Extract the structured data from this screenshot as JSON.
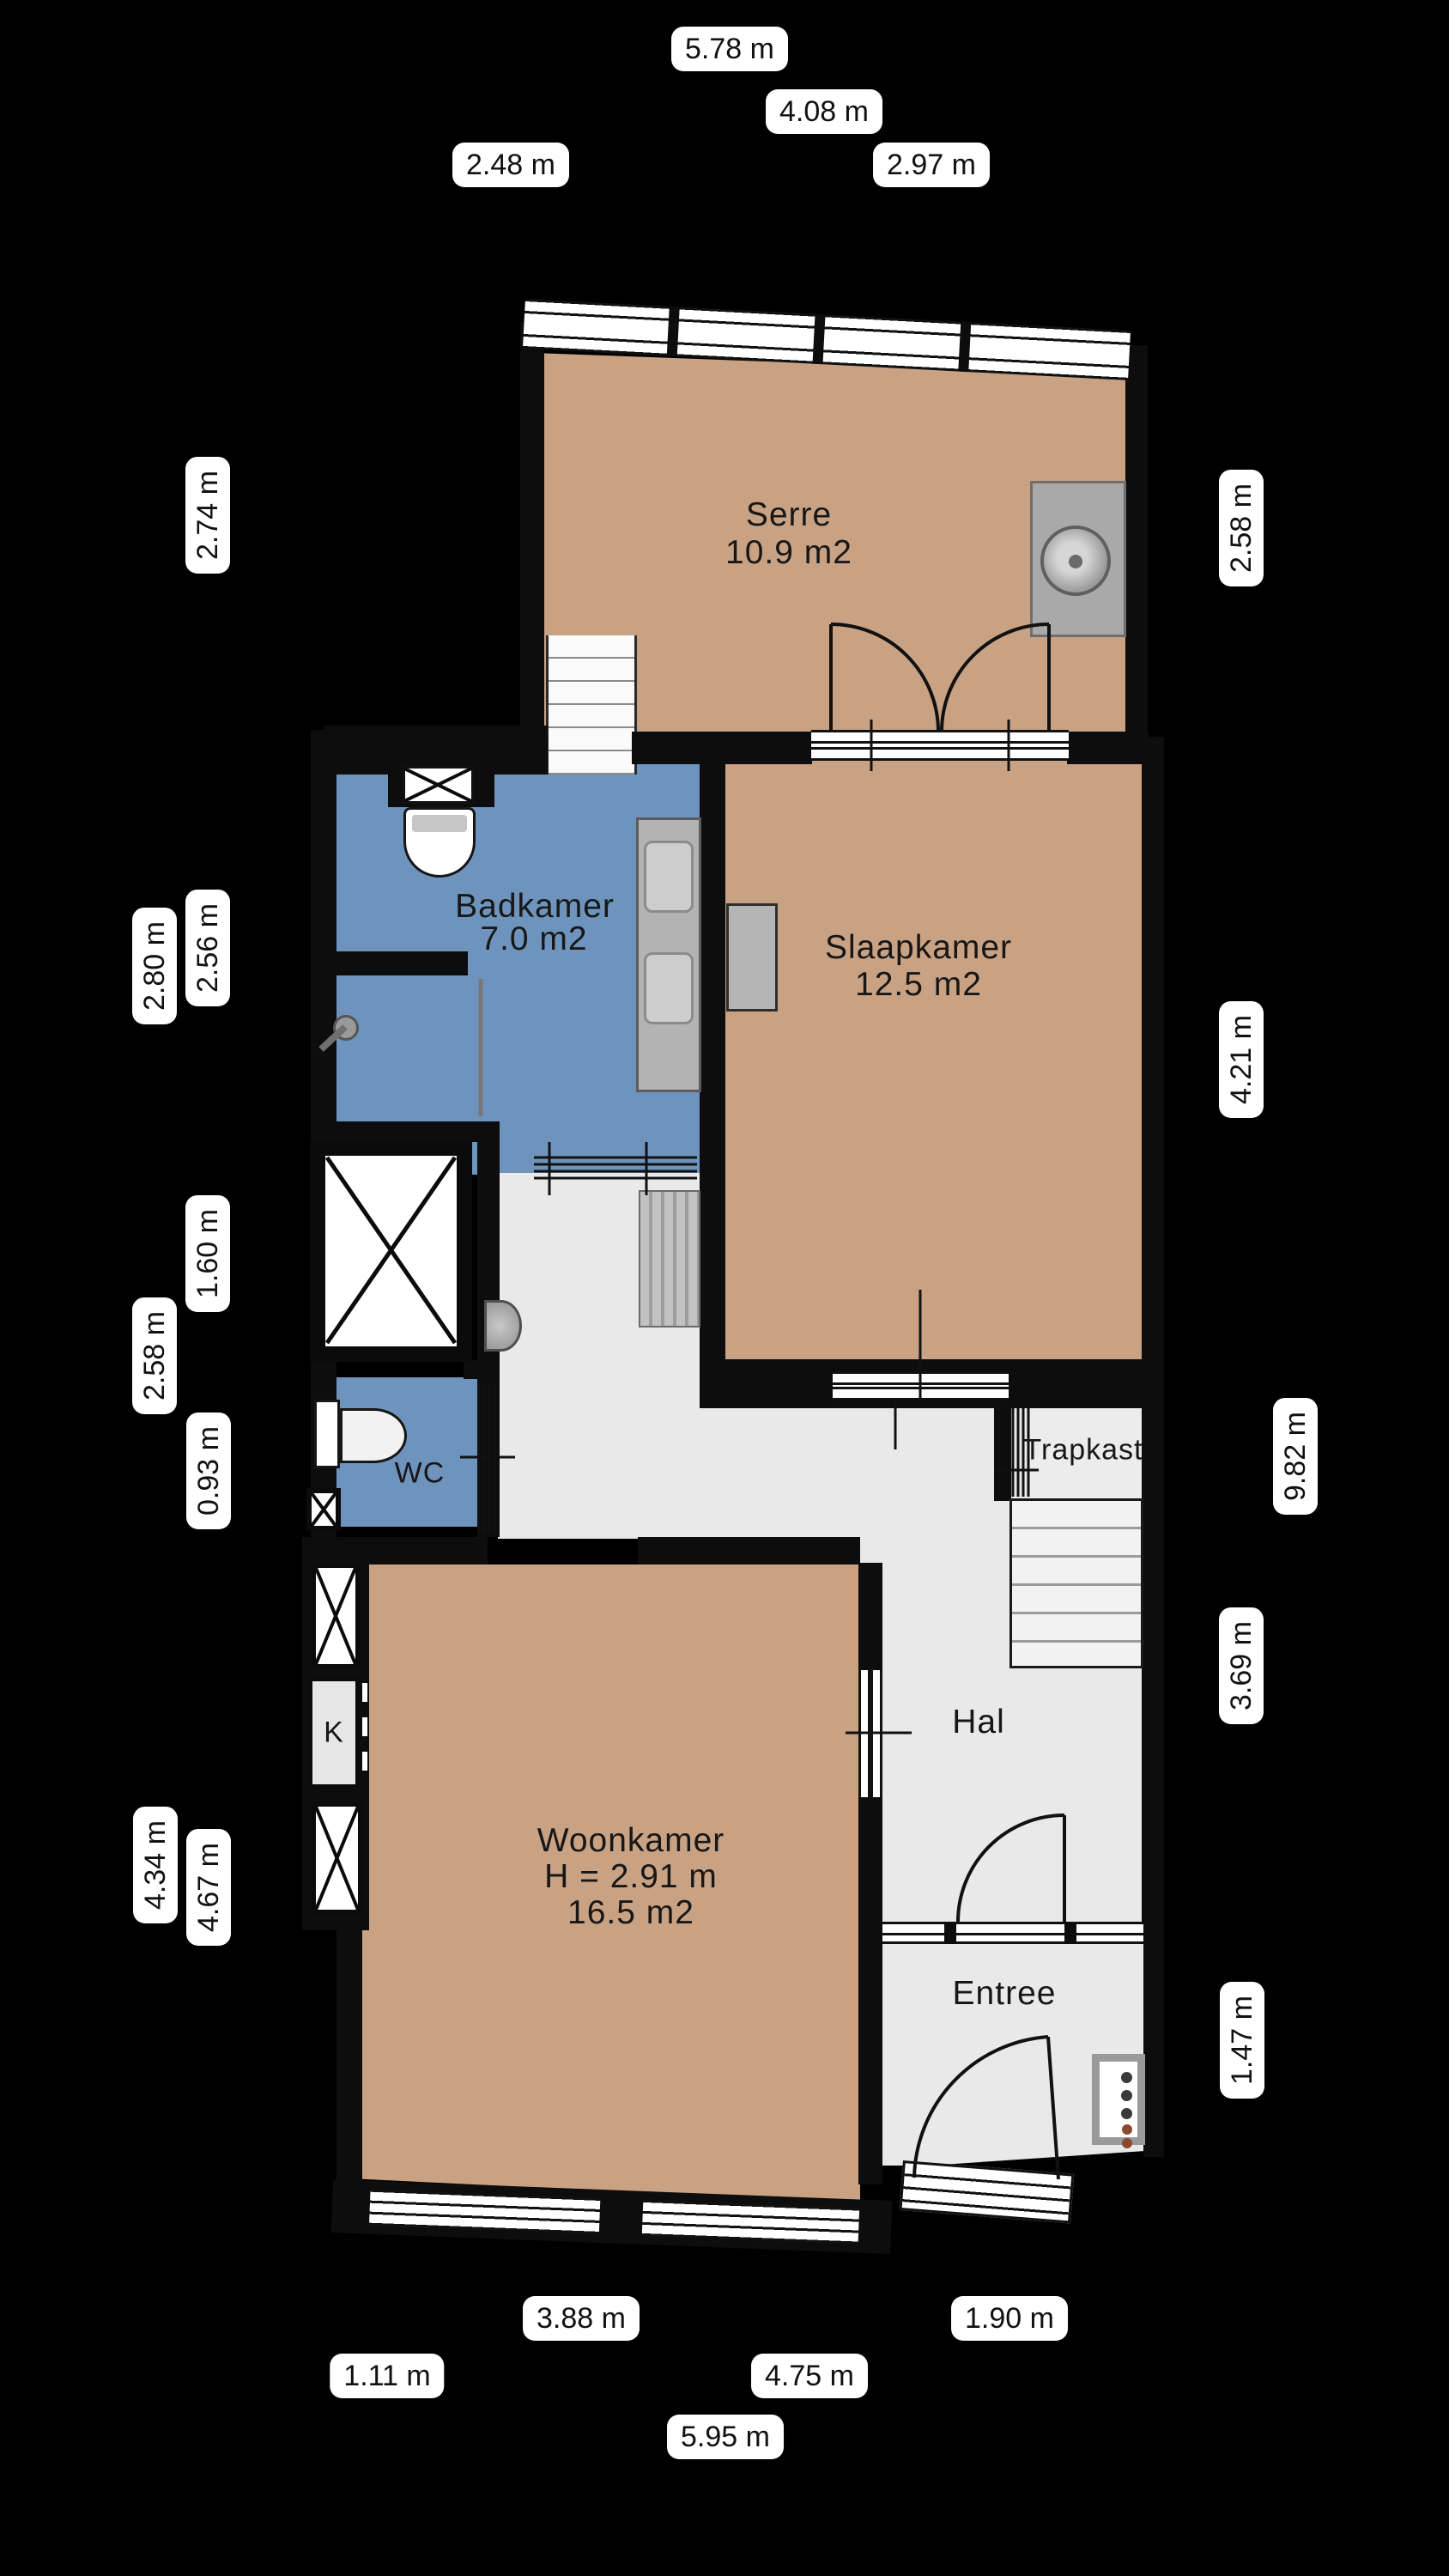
{
  "rooms": {
    "serre": {
      "name": "Serre",
      "area": "10.9 m2"
    },
    "badkamer": {
      "name": "Badkamer",
      "area": "7.0 m2"
    },
    "slaapkamer": {
      "name": "Slaapkamer",
      "area": "12.5 m2"
    },
    "wc": {
      "name": "WC"
    },
    "trapkast": {
      "name": "Trapkast"
    },
    "hal": {
      "name": "Hal"
    },
    "woonkamer": {
      "name": "Woonkamer",
      "height": "H = 2.91 m",
      "area": "16.5 m2"
    },
    "entree": {
      "name": "Entree"
    },
    "kast": {
      "name": "K"
    }
  },
  "dimensions": {
    "top": [
      "5.78 m",
      "4.08 m",
      "2.48 m",
      "2.97 m"
    ],
    "bottom": [
      "3.88 m",
      "1.90 m",
      "1.11 m",
      "4.75 m",
      "5.95 m"
    ],
    "left": [
      "2.74 m",
      "2.80 m",
      "2.56 m",
      "1.60 m",
      "2.58 m",
      "0.93 m",
      "4.34 m",
      "4.67 m"
    ],
    "right": [
      "2.58 m",
      "4.21 m",
      "9.82 m",
      "3.69 m",
      "1.47 m"
    ]
  },
  "icons": {
    "washing_machine": "drum-circle",
    "toilet": "bowl-shape",
    "sink": "basin-shape",
    "shower": "head-circle",
    "stairs": "tread-lines",
    "meter_cabinet": "dot-panel",
    "shaft": "x-cross"
  },
  "colors": {
    "background": "#000000",
    "floor_wood": "#c9a284",
    "floor_bath": "#6e94bd",
    "floor_hall": "#e9e9e9",
    "wall": "#0d0d0d",
    "fixture_gray": "#b5b5b5",
    "label_bg": "#ffffff",
    "label_text": "#111111"
  }
}
